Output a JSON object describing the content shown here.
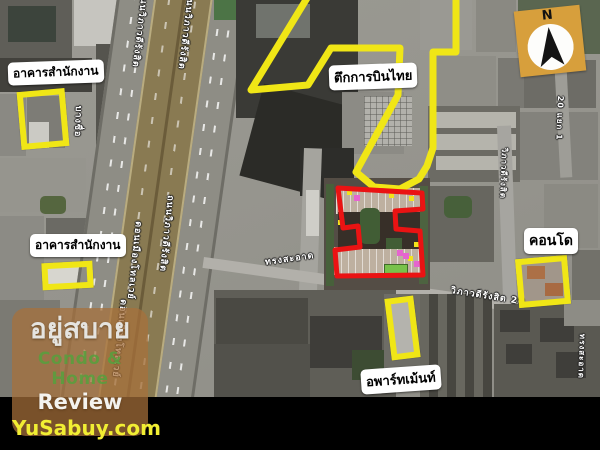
{
  "annotations": {
    "office_top": "อาคารสำนักงาน",
    "thai_airways_building": "ตึกการบินไทย",
    "office_mid": "อาคารสำนักงาน",
    "condo": "คอนโด",
    "apartment": "อพาร์ทเม้นท์"
  },
  "road_labels": {
    "vibhavadi_top_1": "ถนนวิภาวดีรังสิต",
    "vibhavadi_top_2": "ถนนวิภาวดีรังสิต",
    "bang_sue": "บางซื่อ",
    "tollway_mid": "ดอนเมืองโทลเวย์",
    "vibhavadi_mid": "ถนนวิภาวดีรังสิต",
    "tollway_bottom": "ดอนเมืองโทลเวย์",
    "soi_vibhavadi": "วิภาวดีรังสิต",
    "soi_20_yaek1": "20 แยก 1",
    "song_sa_ard": "ทรงสะอาด",
    "vibhavadi_20": "วิภาวดีรังสิต 20",
    "song_sa_ard_side": "ทรงสะอาด"
  },
  "compass": {
    "north": "N"
  },
  "watermark": {
    "brand": "อยู่สบาย",
    "tagline_line1": "Condo & Home",
    "tagline_line2": "Review",
    "website": "YuSabuy.com"
  },
  "colors": {
    "annotation_yellow": "#f0e616",
    "highlight_red": "#ea1313",
    "label_background": "#ffffff",
    "label_text": "#000000",
    "compass_square": "#d79f3c",
    "watermark_panel": "rgba(168,112,58,0.72)",
    "watermark_green": "#589e3e",
    "watermark_yellow": "#f1ee33"
  }
}
